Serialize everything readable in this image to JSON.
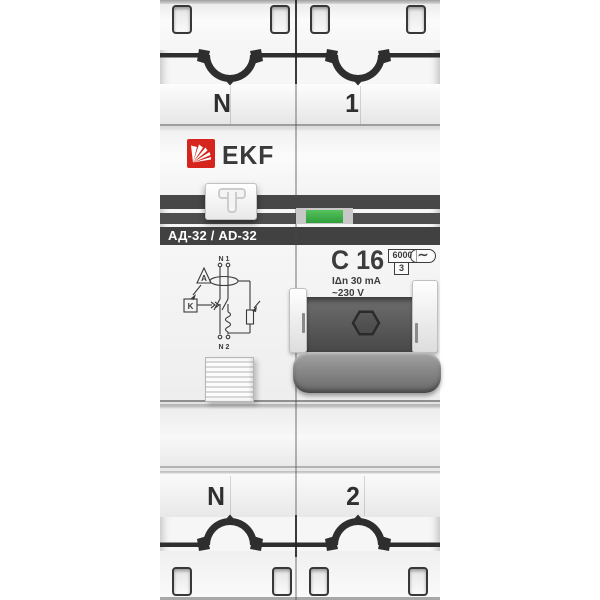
{
  "background_color": "#ffffff",
  "device": {
    "brand": "EKF",
    "model_label": "АД-32 / AD-32",
    "terminal_labels": {
      "top_left": "N",
      "top_right": "1",
      "bottom_left": "N",
      "bottom_right": "2"
    },
    "ratings": {
      "curve_and_current": "C 16",
      "breaking_capacity": "6000",
      "current_limiting_class": "3",
      "ac_type_symbol": "∼",
      "rated_residual_current": "IΔn 30 mA",
      "rated_voltage": "~230 V"
    },
    "toggle": {
      "state": "off",
      "glyph": "T"
    },
    "diagram": {
      "top_label": "N 1",
      "bottom_label": "N 2",
      "relay_label": "K",
      "amp_label": "A"
    },
    "colors": {
      "brand_red": "#d5251d",
      "indicator_green": "#3cb349",
      "stripe_dark": "#454545",
      "body_light": "#f5f5f5"
    }
  }
}
